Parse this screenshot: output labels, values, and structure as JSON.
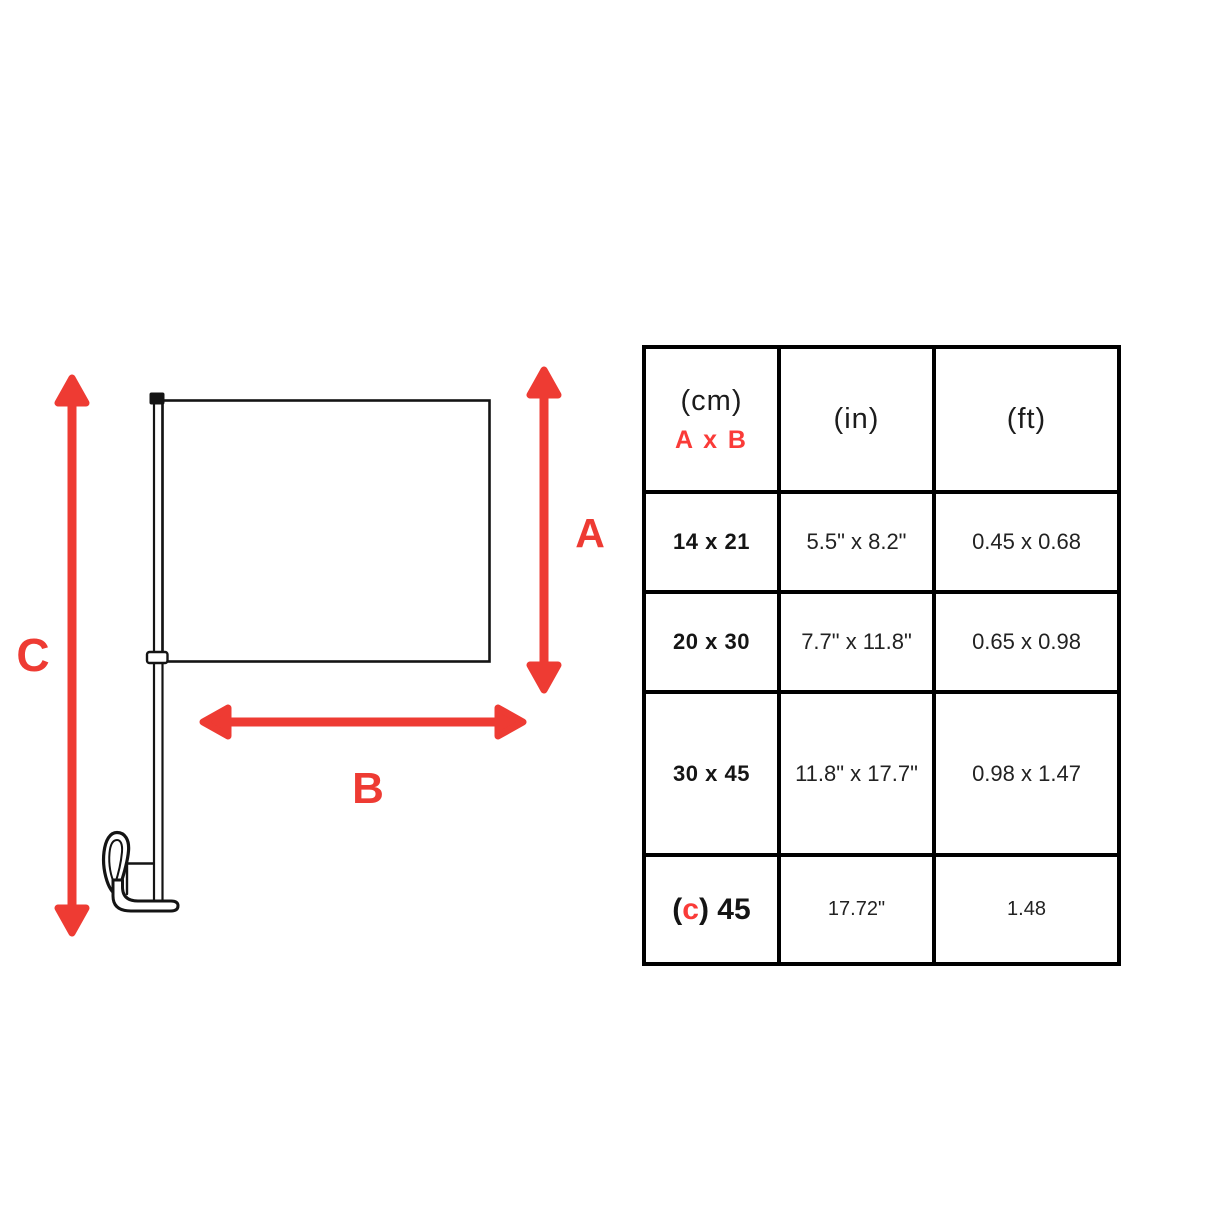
{
  "colors": {
    "arrow": "#ee3b33",
    "accent": "#fa3b38",
    "line": "#141414"
  },
  "diagram": {
    "labels": {
      "a": "A",
      "b": "B",
      "c": "C"
    },
    "parts": [
      "flag-panel",
      "flag-pole",
      "pole-cap",
      "pole-collar",
      "window-clip"
    ]
  },
  "table": {
    "header": {
      "cm_unit": "(cm)",
      "cm_sub": "A x B",
      "in_unit": "(in)",
      "ft_unit": "(ft)"
    },
    "rows": [
      {
        "cm": "14 x 21",
        "in": "5.5\" x 8.2\"",
        "ft": "0.45 x 0.68"
      },
      {
        "cm": "20 x 30",
        "in": "7.7\" x 11.8\"",
        "ft": "0.65 x 0.98"
      },
      {
        "cm": "30 x 45",
        "in": "11.8\" x 17.7\"",
        "ft": "0.98 x 1.47"
      },
      {
        "cm": "(c) 45",
        "cm_parts": {
          "prefix": "(",
          "c": "c",
          "suffix": ") 45"
        },
        "in": "17.72\"",
        "ft": "1.48"
      }
    ]
  }
}
